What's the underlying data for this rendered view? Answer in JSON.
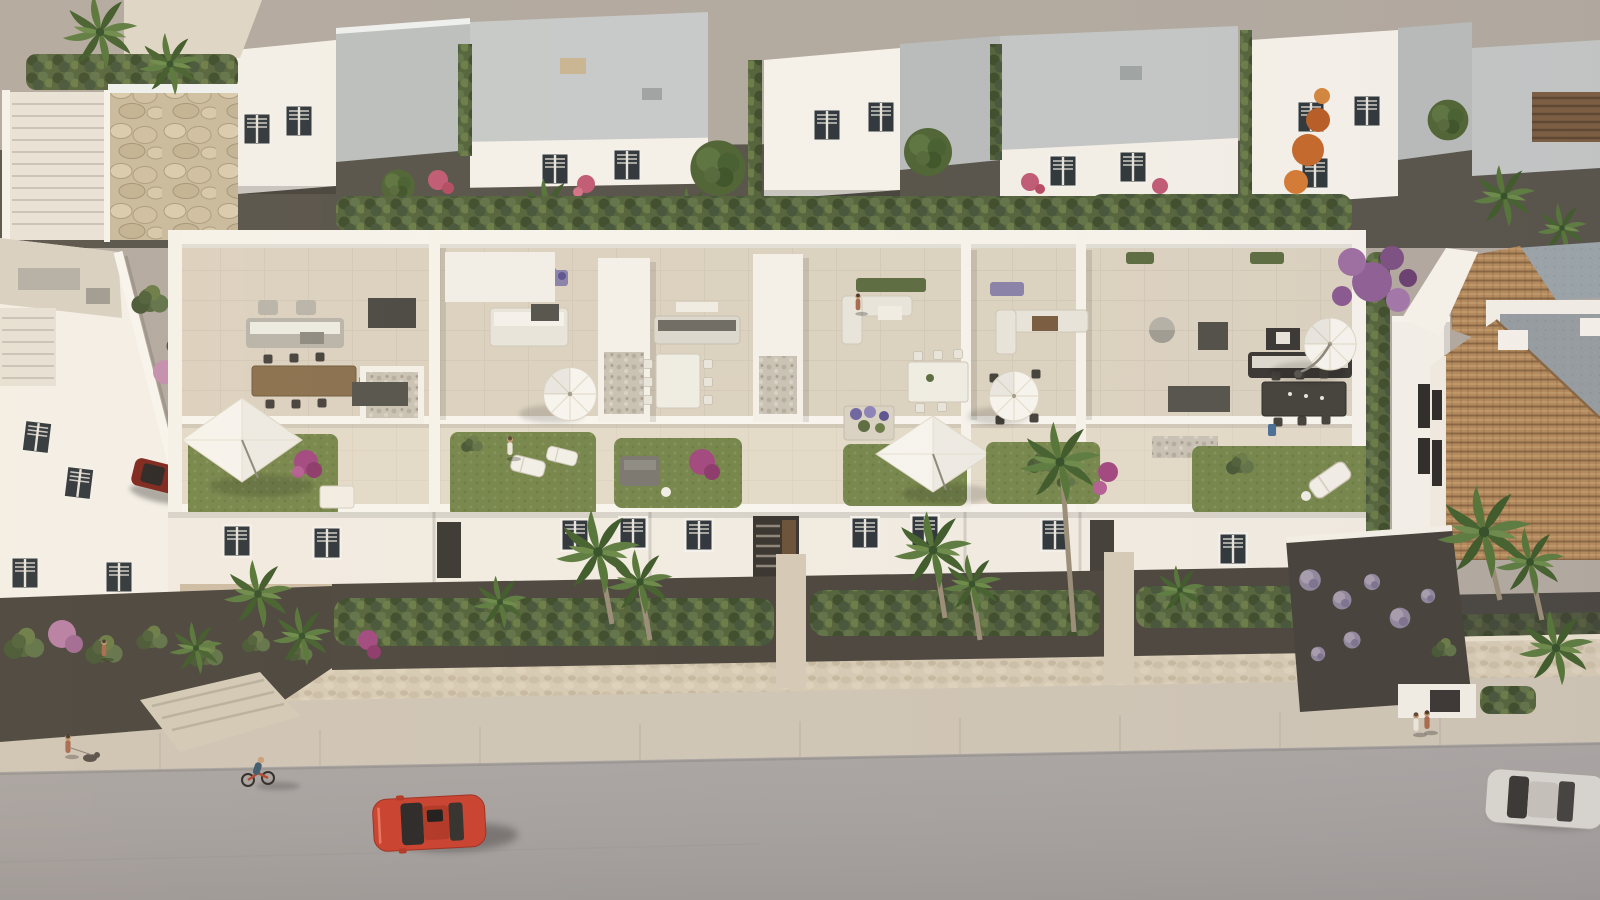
{
  "image": {
    "kind": "aerial 3D architectural rendering",
    "subject": "white Mediterranean townhouse development with rooftop terraces",
    "foreground": "stone retaining wall, sidewalk and asphalt street",
    "lighting": "warm low-angle sunlight from the left"
  },
  "palette": {
    "road": "#a7a2a0",
    "sidewalk": "#cfc5b5",
    "stone_wall": "#d6cab4",
    "soil": "#4c463e",
    "hedge": "#55643c",
    "lawn": "#76864b",
    "terrace_floor": "#dcd2c0",
    "white_sunlit": "#f5f1e9",
    "white_shaded": "#ded7ca",
    "roof_gray": "#bcbfbe",
    "pergola": "#55534c",
    "pebble": "#c9c2b4",
    "umbrella": "#f7f4ee",
    "wood": "#8a6f4e",
    "red_car": "#c8402e",
    "parked_red_car": "#7d241c",
    "silver_car": "#d9d6d0",
    "terracotta_roof": "#b48a5c",
    "orange_tree": "#c4682a",
    "purple_bloom": "#8e5f93",
    "magenta_bloom": "#a2487f",
    "palm_green": "#5d7c40",
    "tree_green": "#4f6434"
  },
  "inventory": {
    "terrace_units": 6,
    "rooftop_lawns": 6,
    "umbrellas": {
      "round": 3,
      "square_sails": 2
    },
    "vehicles": [
      "red car driving on road",
      "silver car at right edge of road",
      "dark red car parked by left building"
    ],
    "pedestrians": [
      "woman walking a dog on left sidewalk",
      "cyclist on road",
      "couple on right sidewalk",
      "person on left garden path",
      "person on terrace sofa",
      "person standing on rooftop lawn"
    ],
    "vegetation": [
      "palm trees",
      "clipped hedge rows",
      "round leafy trees",
      "orange flowering tree",
      "purple bougainvillea",
      "lavender ball shrubs",
      "magenta shrubs"
    ]
  }
}
